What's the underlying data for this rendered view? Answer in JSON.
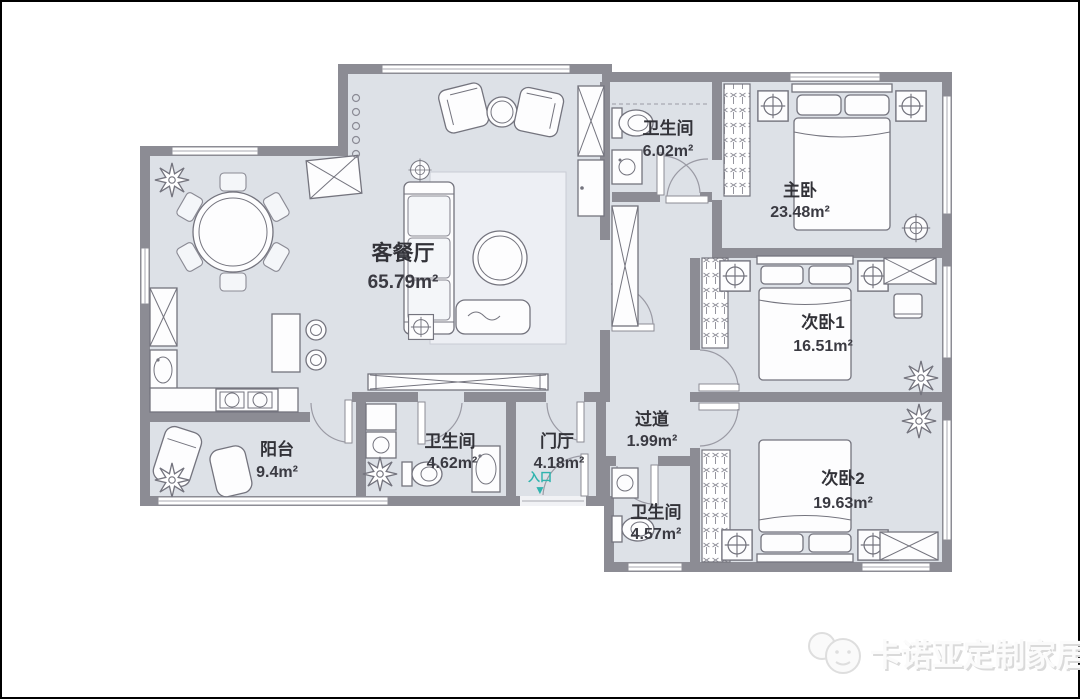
{
  "plan": {
    "rooms": [
      {
        "id": "living",
        "name": "客餐厅",
        "area": "65.79m²"
      },
      {
        "id": "bath_top",
        "name": "卫生间",
        "area": "6.02m²"
      },
      {
        "id": "master",
        "name": "主卧",
        "area": "23.48m²"
      },
      {
        "id": "bed2",
        "name": "次卧1",
        "area": "16.51m²"
      },
      {
        "id": "corridor",
        "name": "过道",
        "area": "1.99m²"
      },
      {
        "id": "bed3",
        "name": "次卧2",
        "area": "19.63m²"
      },
      {
        "id": "bath_mid",
        "name": "卫生间",
        "area": "4.57m²"
      },
      {
        "id": "balcony",
        "name": "阳台",
        "area": "9.4m²"
      },
      {
        "id": "bath_left",
        "name": "卫生间",
        "area": "4.62m²"
      },
      {
        "id": "hall",
        "name": "门厅",
        "area": "4.18m²"
      }
    ],
    "entrance": {
      "label": "入口",
      "arrow": "▼",
      "color": "#2fb3ae"
    },
    "colors": {
      "wall": "#8c8c94",
      "floor": "#dde1e7",
      "furniture_line": "#74747e"
    }
  },
  "watermark": {
    "text": "卡诺亚定制家居"
  }
}
